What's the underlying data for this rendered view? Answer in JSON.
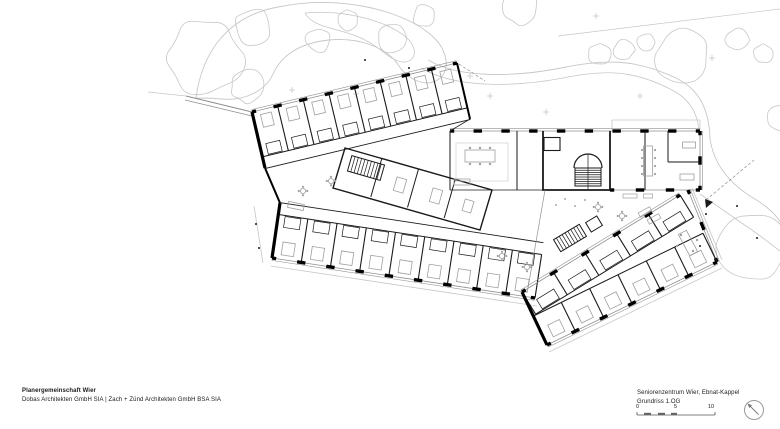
{
  "title_block": {
    "firm_name": "Planergemeinschaft Wier",
    "firm_members": "Dobas Architekten GmbH SIA | Zach + Zünd Architekten GmbH BSA SIA"
  },
  "project_block": {
    "project_name": "Seniorenzentrum Wier, Ebnat-Kappel",
    "drawing_name": "Grundriss 1.OG"
  },
  "scale_bar": {
    "label_0": "0",
    "label_5": "5",
    "label_10": "10",
    "unit_meters": 10
  },
  "north_arrow": {
    "icon": "north-arrow-icon",
    "direction": "up-left"
  },
  "colors": {
    "paper": "#ffffff",
    "wall": "#000000",
    "dark": "#1a1a1a",
    "mid": "#8f8f8f",
    "light": "#c7c7c7",
    "furn": "#9f9f9f"
  },
  "drawing": {
    "strokes": {
      "wall": "#000000",
      "dark": "#1a1a1a",
      "mid": "#8f8f8f",
      "light": "#c7c7c7",
      "furn": "#9f9f9f"
    },
    "prims": [
      {
        "t": "path",
        "d": "M196,98 C202,52 228,16 278,7 C335,-5 398,8 430,34 C448,49 451,70 439,79 C427,88 408,80 399,66 C387,47 358,37 329,40 C299,43 281,56 273,74 C265,92 243,101 222,99 C212,98 200,98 196,98",
        "c": "light",
        "w": 0.9
      },
      {
        "t": "path",
        "d": "M305,13 C345,9 392,22 409,40 C419,52 414,63 402,62 C388,60 380,45 356,36 C336,28 312,27 305,13",
        "c": "light",
        "w": 0.8
      },
      {
        "t": "path",
        "d": "M428,60 C462,80 520,76 561,68 C608,58 638,60 676,78 C700,90 709,110 710,138",
        "c": "light",
        "w": 0.9
      },
      {
        "t": "path",
        "d": "M421,68 C458,90 521,86 563,78 C607,69 634,71 668,88 C690,98 699,113 700,140",
        "c": "light",
        "w": 0.8
      },
      {
        "t": "path",
        "d": "M710,138 C713,163 729,184 755,199 C768,207 777,216 780,222",
        "c": "light",
        "w": 0.9
      },
      {
        "t": "path",
        "d": "M558,36 L780,9",
        "c": "light",
        "w": 0.7
      },
      {
        "t": "path",
        "d": "M148,92 L186,96",
        "c": "light",
        "w": 0.7
      },
      {
        "t": "path",
        "d": "M186,96 L252,112",
        "c": "mid",
        "w": 1
      },
      {
        "t": "path",
        "d": "M185,100 L252,116",
        "c": "mid",
        "w": 0.7
      },
      {
        "t": "tree",
        "x": 205,
        "y": 58,
        "r": 40,
        "s": 1
      },
      {
        "t": "tree",
        "x": 253,
        "y": 28,
        "r": 20,
        "s": 2
      },
      {
        "t": "tree",
        "x": 247,
        "y": 86,
        "r": 18,
        "s": 3
      },
      {
        "t": "tree",
        "x": 318,
        "y": 40,
        "r": 13,
        "s": 4
      },
      {
        "t": "tree",
        "x": 347,
        "y": 20,
        "r": 11,
        "s": 5
      },
      {
        "t": "tree",
        "x": 392,
        "y": 38,
        "r": 15,
        "s": 6
      },
      {
        "t": "tree",
        "x": 424,
        "y": 16,
        "r": 12,
        "s": 7
      },
      {
        "t": "tree",
        "x": 520,
        "y": 8,
        "r": 18,
        "s": 8
      },
      {
        "t": "tree",
        "x": 600,
        "y": 54,
        "r": 12,
        "s": 9
      },
      {
        "t": "tree",
        "x": 624,
        "y": 50,
        "r": 11,
        "s": 10
      },
      {
        "t": "tree",
        "x": 646,
        "y": 42,
        "r": 9,
        "s": 11
      },
      {
        "t": "tree",
        "x": 682,
        "y": 56,
        "r": 28,
        "s": 12
      },
      {
        "t": "tree",
        "x": 737,
        "y": 40,
        "r": 12,
        "s": 13
      },
      {
        "t": "tree",
        "x": 763,
        "y": 54,
        "r": 10,
        "s": 14
      },
      {
        "t": "tree",
        "x": 752,
        "y": 248,
        "r": 36,
        "s": 15
      },
      {
        "t": "tree",
        "x": 780,
        "y": 118,
        "r": 14,
        "s": 16
      },
      {
        "t": "shrub",
        "x": 292,
        "y": 90
      },
      {
        "t": "shrub",
        "x": 356,
        "y": 94
      },
      {
        "t": "shrub",
        "x": 470,
        "y": 76
      },
      {
        "t": "shrub",
        "x": 490,
        "y": 96
      },
      {
        "t": "shrub",
        "x": 546,
        "y": 112
      },
      {
        "t": "shrub",
        "x": 640,
        "y": 96
      },
      {
        "t": "shrub",
        "x": 712,
        "y": 58
      },
      {
        "t": "shrub",
        "x": 596,
        "y": 16
      },
      {
        "t": "path",
        "d": "M254,206 L263,263",
        "c": "light",
        "w": 0.8
      },
      {
        "t": "path",
        "d": "M271,266 L537,306",
        "c": "light",
        "w": 0.8
      },
      {
        "t": "path",
        "d": "M549,352 L722,268",
        "c": "light",
        "w": 0.8
      },
      {
        "t": "path",
        "d": "M692,188 L722,260",
        "c": "light",
        "w": 0.8
      },
      {
        "t": "path",
        "d": "M612,120 L700,120 M612,120 L612,130 M700,120 L700,130",
        "c": "light",
        "w": 0.8
      },
      {
        "t": "path",
        "d": "M700,194 L759,235 M759,235 L780,251",
        "c": "light",
        "w": 0.8
      },
      {
        "t": "path",
        "d": "M706,200 L754,160",
        "c": "mid",
        "w": 0.7,
        "dash": "3,2"
      },
      {
        "t": "path",
        "d": "M459,64 L485,81",
        "c": "mid",
        "w": 0.7,
        "dash": "3,2"
      },
      {
        "t": "rooms",
        "x1": 252,
        "y1": 112,
        "x2": 457,
        "y2": 63,
        "n": 8,
        "d": 46,
        "nx": 0.2325,
        "ny": 0.9724,
        "bed": 1,
        "bath": 1,
        "cor": 58
      },
      {
        "t": "bays",
        "x1": 252,
        "y1": 112,
        "x2": 457,
        "y2": 63,
        "n": 8,
        "ox": -0.2325,
        "oy": -0.9724
      },
      {
        "t": "rooms",
        "x1": 272,
        "y1": 258,
        "x2": 535,
        "y2": 298,
        "n": 9,
        "d": 44,
        "nx": 0.1504,
        "ny": -0.9887,
        "bed": 1,
        "bath": 1,
        "cor": 56
      },
      {
        "t": "bays",
        "x1": 272,
        "y1": 258,
        "x2": 535,
        "y2": 298,
        "n": 9,
        "ox": -0.1504,
        "oy": 0.9887
      },
      {
        "t": "bays",
        "x1": 450,
        "y1": 131,
        "x2": 700,
        "y2": 131,
        "n": 9,
        "ox": 0,
        "oy": -1
      },
      {
        "t": "bays",
        "x1": 700,
        "y1": 131,
        "x2": 700,
        "y2": 190,
        "n": 2,
        "ox": 1,
        "oy": 0
      },
      {
        "t": "bays",
        "x1": 610,
        "y1": 190,
        "x2": 700,
        "y2": 190,
        "n": 3
      },
      {
        "t": "bays",
        "x1": 688,
        "y1": 190,
        "x2": 717,
        "y2": 262,
        "n": 2,
        "ox": 0.928,
        "oy": -0.374
      },
      {
        "t": "rooms",
        "x1": 717,
        "y1": 262,
        "x2": 547,
        "y2": 345,
        "n": 6,
        "d": 32,
        "nx": -0.4387,
        "ny": -0.8985,
        "bed": 1
      },
      {
        "t": "bays",
        "x1": 717,
        "y1": 262,
        "x2": 547,
        "y2": 345,
        "n": 6,
        "ox": 0.4387,
        "oy": 0.8985
      },
      {
        "t": "rooms",
        "x1": 522,
        "y1": 292,
        "x2": 680,
        "y2": 195,
        "n": 5,
        "d": 26,
        "nx": 0.5232,
        "ny": 0.8522,
        "bath": 1
      },
      {
        "t": "bays",
        "x1": 522,
        "y1": 292,
        "x2": 680,
        "y2": 195,
        "n": 5,
        "ox": -0.5232,
        "oy": -0.8522
      },
      {
        "t": "path",
        "d": "M252,112 L265,168",
        "c": "wall",
        "w": 3.2
      },
      {
        "t": "path",
        "d": "M272,258 L280,203",
        "c": "wall",
        "w": 3.2
      },
      {
        "t": "path",
        "d": "M265,168 L280,203",
        "c": "wall",
        "w": 2
      },
      {
        "t": "path",
        "d": "M457,63 L470,119",
        "c": "wall",
        "w": 2
      },
      {
        "t": "path",
        "d": "M547,345 L522,292",
        "c": "wall",
        "w": 3.2
      },
      {
        "t": "path",
        "d": "M470,119 L450,131",
        "c": "dark",
        "w": 0.8
      },
      {
        "t": "path",
        "d": "M450,131 L450,190",
        "c": "dark",
        "w": 1
      },
      {
        "t": "path",
        "d": "M450,190 L543,190",
        "c": "dark",
        "w": 0.8
      },
      {
        "t": "path",
        "d": "M543,131 L543,190 L610,190",
        "c": "dark",
        "w": 1.8
      },
      {
        "t": "path",
        "d": "M610,131 L610,190",
        "c": "dark",
        "w": 1.8
      },
      {
        "t": "path",
        "d": "M517,131 L517,190",
        "c": "dark",
        "w": 1
      },
      {
        "t": "path",
        "d": "M645,131 L645,190",
        "c": "dark",
        "w": 1
      },
      {
        "t": "path",
        "d": "M668,131 L668,162 M668,162 L700,162",
        "c": "dark",
        "w": 1
      },
      {
        "t": "path",
        "d": "M545,190 L528,288",
        "c": "mid",
        "w": 0.7
      },
      {
        "t": "path",
        "d": "M345,148 L492,190 L480,230 L333,188 Z",
        "c": "dark",
        "w": 1.4
      },
      {
        "t": "path",
        "d": "M381.8,158.5 L370.8,197",
        "c": "dark",
        "w": 1
      },
      {
        "t": "path",
        "d": "M418.5,169 L407.5,207.5",
        "c": "dark",
        "w": 1
      },
      {
        "t": "path",
        "d": "M455.2,179.5 L444.2,218",
        "c": "dark",
        "w": 1
      },
      {
        "t": "hatch",
        "x": 366,
        "y": 168,
        "w": 34,
        "h": 16,
        "a": 16,
        "n": 9
      },
      {
        "t": "path",
        "d": "M574,168 A14,14 0 0 1 602,168",
        "c": "dark",
        "w": 1.2
      },
      {
        "t": "hatch",
        "x": 588,
        "y": 177,
        "w": 18,
        "h": 26,
        "a": 90,
        "n": 7
      },
      {
        "t": "path",
        "d": "M588,154 L588,190",
        "c": "dark",
        "w": 0.7
      },
      {
        "t": "rrect",
        "x": 552,
        "y": 144,
        "w": 16,
        "h": 13,
        "a": 0,
        "c": "dark",
        "lw": 1.1
      },
      {
        "t": "hatch",
        "x": 570,
        "y": 238,
        "w": 30,
        "h": 14,
        "a": -31,
        "n": 8
      },
      {
        "t": "rrect",
        "x": 594,
        "y": 224,
        "w": 13,
        "h": 11,
        "a": -31,
        "c": "dark",
        "lw": 1
      },
      {
        "t": "rrect",
        "x": 482,
        "y": 162,
        "w": 52,
        "h": 38,
        "a": 0,
        "c": "light",
        "lw": 0.6
      },
      {
        "t": "rrect",
        "x": 480,
        "y": 156,
        "w": 30,
        "h": 12,
        "a": 0,
        "c": "furn",
        "lw": 0.8
      },
      {
        "t": "dots",
        "pts": [
          [
            470,
            148
          ],
          [
            480,
            148
          ],
          [
            490,
            148
          ],
          [
            470,
            164
          ],
          [
            480,
            164
          ],
          [
            490,
            164
          ]
        ],
        "r": 1.2,
        "c": "furn"
      },
      {
        "t": "rrect",
        "x": 462,
        "y": 182,
        "w": 16,
        "h": 6,
        "a": 0,
        "c": "furn",
        "lw": 0.8
      },
      {
        "t": "rrect",
        "x": 648,
        "y": 161,
        "w": 9,
        "h": 30,
        "a": 0,
        "c": "furn",
        "lw": 0.8
      },
      {
        "t": "dots",
        "pts": [
          [
            642,
            150
          ],
          [
            642,
            158
          ],
          [
            642,
            166
          ],
          [
            642,
            174
          ],
          [
            655,
            150
          ],
          [
            655,
            158
          ],
          [
            655,
            166
          ],
          [
            655,
            174
          ]
        ],
        "r": 1.1,
        "c": "furn"
      },
      {
        "t": "rrect",
        "x": 689,
        "y": 145,
        "w": 13,
        "h": 6,
        "a": 0,
        "c": "furn",
        "lw": 0.8
      },
      {
        "t": "rrect",
        "x": 687,
        "y": 177,
        "w": 14,
        "h": 6,
        "a": 0,
        "c": "furn",
        "lw": 0.8
      },
      {
        "t": "rrect",
        "x": 630,
        "y": 196,
        "w": 14,
        "h": 4,
        "a": 0,
        "c": "furn",
        "lw": 0.7
      },
      {
        "t": "rrect",
        "x": 648,
        "y": 196,
        "w": 9,
        "h": 4,
        "a": 0,
        "c": "furn",
        "lw": 0.7
      },
      {
        "t": "rrect",
        "x": 688,
        "y": 243,
        "w": 9,
        "h": 24,
        "a": -28,
        "c": "furn",
        "lw": 0.8
      },
      {
        "t": "dots",
        "pts": [
          [
            681,
            235
          ],
          [
            677,
            246
          ],
          [
            697,
            240
          ],
          [
            693,
            251
          ]
        ],
        "r": 1.2,
        "c": "furn"
      },
      {
        "t": "rrect",
        "x": 400,
        "y": 185,
        "w": 10,
        "h": 14,
        "a": 16,
        "c": "furn",
        "lw": 0.8
      },
      {
        "t": "rrect",
        "x": 436,
        "y": 196,
        "w": 10,
        "h": 14,
        "a": 16,
        "c": "furn",
        "lw": 0.8
      },
      {
        "t": "rrect",
        "x": 468,
        "y": 206,
        "w": 9,
        "h": 12,
        "a": 16,
        "c": "furn",
        "lw": 0.8
      },
      {
        "t": "table",
        "x": 303,
        "y": 191
      },
      {
        "t": "table",
        "x": 331,
        "y": 181
      },
      {
        "t": "rrect",
        "x": 296,
        "y": 206,
        "w": 16,
        "h": 6,
        "a": 12,
        "c": "furn",
        "lw": 0.8
      },
      {
        "t": "table",
        "x": 502,
        "y": 256
      },
      {
        "t": "table",
        "x": 527,
        "y": 267
      },
      {
        "t": "table",
        "x": 598,
        "y": 207
      },
      {
        "t": "table",
        "x": 622,
        "y": 216
      },
      {
        "t": "rrect",
        "x": 645,
        "y": 212,
        "w": 13,
        "h": 5,
        "a": -28,
        "c": "furn",
        "lw": 0.7
      },
      {
        "t": "rrect",
        "x": 654,
        "y": 219,
        "w": 13,
        "h": 5,
        "a": -28,
        "c": "furn",
        "lw": 0.7
      },
      {
        "t": "dots",
        "pts": [
          [
            585,
            200
          ],
          [
            575,
            206
          ],
          [
            565,
            199
          ],
          [
            556,
            205
          ]
        ],
        "r": 0.9,
        "c": "mid"
      },
      {
        "t": "dots",
        "pts": [
          [
            256,
            224
          ],
          [
            259,
            248
          ],
          [
            706,
            214
          ],
          [
            700,
            246
          ],
          [
            737,
            206
          ],
          [
            757,
            238
          ],
          [
            365,
            60
          ],
          [
            409,
            68
          ]
        ],
        "r": 1,
        "c": "dark"
      },
      {
        "t": "tri",
        "pts": [
          [
            705,
            199
          ],
          [
            713,
            202
          ],
          [
            706,
            208
          ]
        ]
      }
    ]
  }
}
